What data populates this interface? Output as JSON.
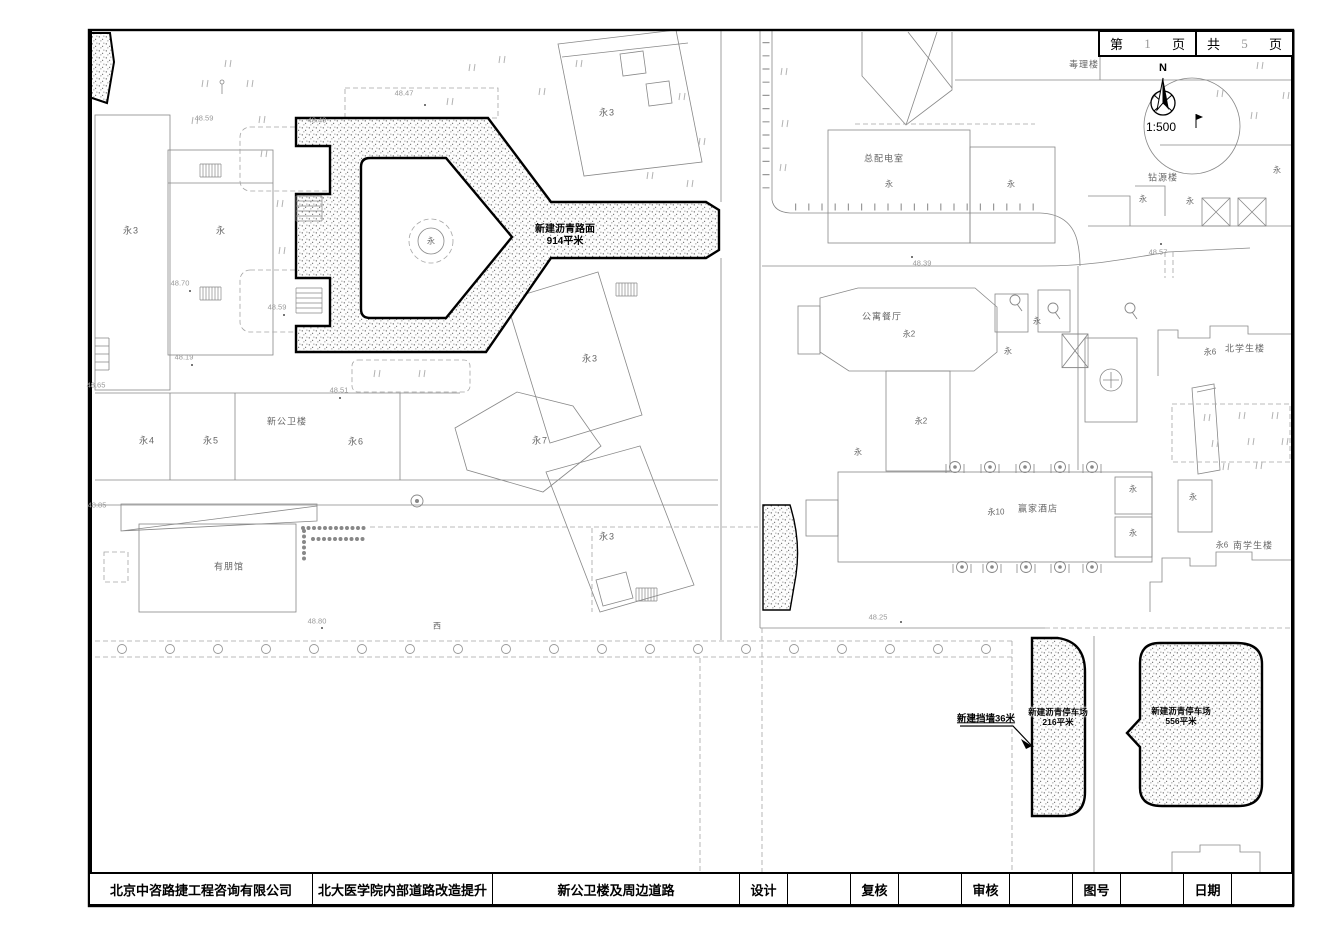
{
  "sheet_box": {
    "page_label": "第",
    "page_number": "1",
    "page_unit": "页",
    "total_label": "共",
    "total_number": "5",
    "total_unit": "页"
  },
  "compass": {
    "north": "N",
    "scale": "1:500"
  },
  "annotations": {
    "new_road_line1": "新建沥青路面",
    "new_road_line2": "914平米",
    "lot_small_line1": "新建沥青停车场",
    "lot_small_line2": "216平米",
    "lot_large_line1": "新建沥青停车场",
    "lot_large_line2": "556平米",
    "retaining_wall": "新建挡墙36米",
    "road_char": "西"
  },
  "labels": {
    "yong": "永",
    "yong2": "永2",
    "yong3": "永3",
    "yong4": "永4",
    "yong5": "永5",
    "yong6": "永6",
    "yong7": "永7",
    "yong10": "永10",
    "new_public_health_building": "新公卫楼",
    "youpeng_hall": "有朋馆",
    "toxicology_building": "毒理楼",
    "main_power_room": "总配电室",
    "zuanyuan_building": "钻源楼",
    "apartment_restaurant": "公寓餐厅",
    "winner_hotel": "赢家酒店",
    "north_student_building": "北学生楼",
    "south_student_building": "南学生楼"
  },
  "elevations": {
    "e4859": "48.59",
    "e4870": "48.70",
    "e4819": "48.19",
    "e4865": "48.65",
    "e4885": "48.85",
    "e4847": "48.47",
    "e4849": "48.49",
    "e4851": "48.51",
    "e4880": "48.80",
    "e4839": "48.39",
    "e4857": "48.57",
    "e4825": "48.25"
  },
  "titleblock": {
    "company": "北京中咨路捷工程咨询有限公司",
    "project": "北大医学院内部道路改造提升",
    "drawing_title": "新公卫楼及周边道路",
    "fields": [
      {
        "label": "设计",
        "value": ""
      },
      {
        "label": "复核",
        "value": ""
      },
      {
        "label": "审核",
        "value": ""
      },
      {
        "label": "图号",
        "value": ""
      },
      {
        "label": "日期",
        "value": ""
      }
    ]
  }
}
